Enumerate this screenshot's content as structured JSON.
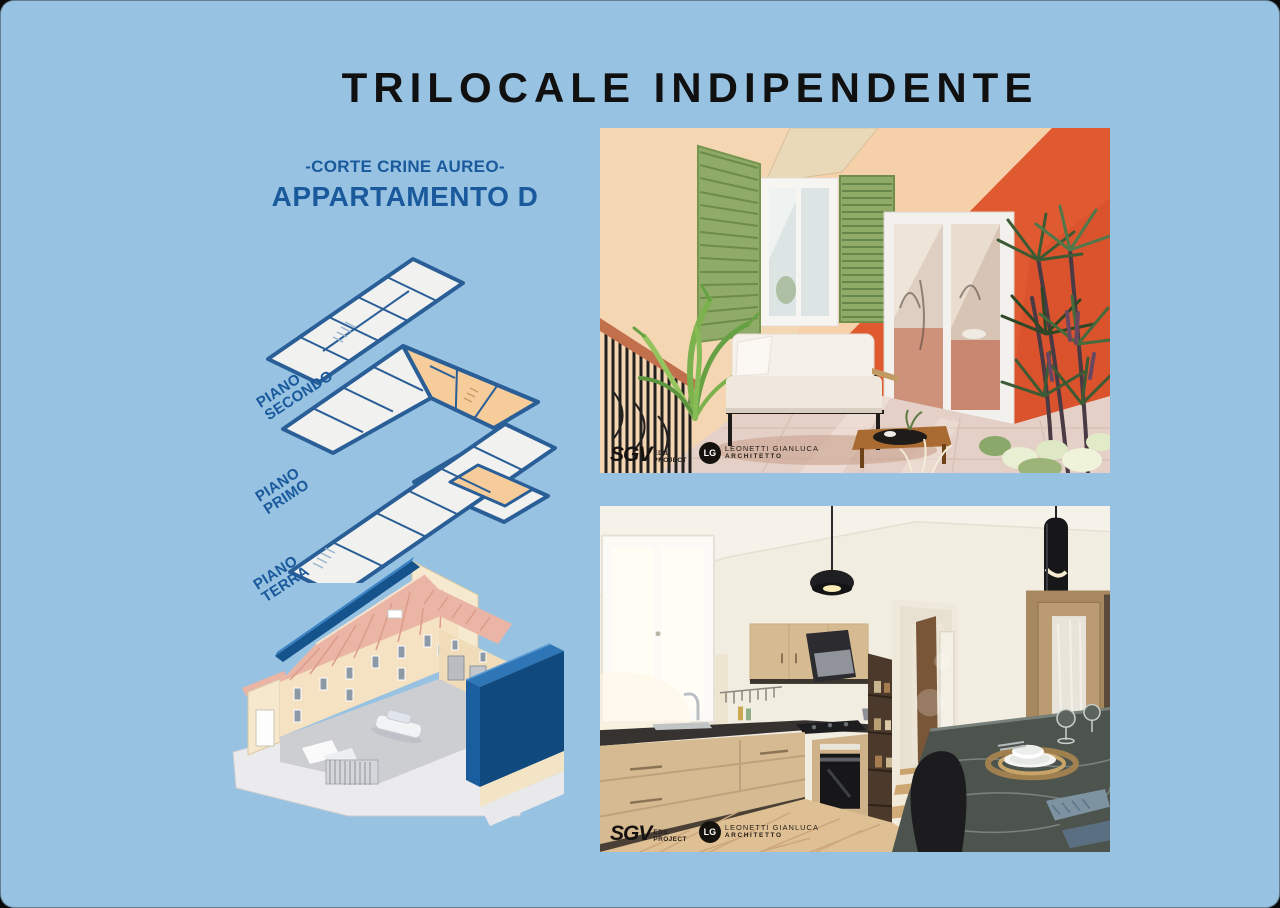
{
  "page": {
    "title": "TRILOCALE INDIPENDENTE",
    "court_name": "-CORTE CRINE AUREO-",
    "apartment_name": "APPARTAMENTO D"
  },
  "floor_plans": {
    "labels": [
      {
        "line1": "PIANO",
        "line2": "SECONDO"
      },
      {
        "line1": "PIANO",
        "line2": "PRIMO"
      },
      {
        "line1": "PIANO",
        "line2": "TERRA"
      }
    ]
  },
  "branding": {
    "sgv": {
      "name": "SGV",
      "line1": "EDIL",
      "line2": "PROJECT"
    },
    "architect": {
      "monogram": "LG",
      "line1": "LEONETTI GIANLUCA",
      "line2": "ARCHITETTO"
    }
  },
  "colors": {
    "page-bg": "#97c2e2",
    "title-color": "#101010",
    "accent-blue": "#1a5a9c",
    "plan-outline": "#2a5e97",
    "plan-fill": "#f1f1ef",
    "plan-highlight": "#f6cd9a",
    "axon-highlight-blue": "#10497e",
    "axon-roof": "#eab5a5",
    "axon-wall": "#f4e2c2",
    "terrace-wall": "#e05a31",
    "shutter-green": "#8fab67",
    "kitchen-wood": "#d6bb92"
  }
}
